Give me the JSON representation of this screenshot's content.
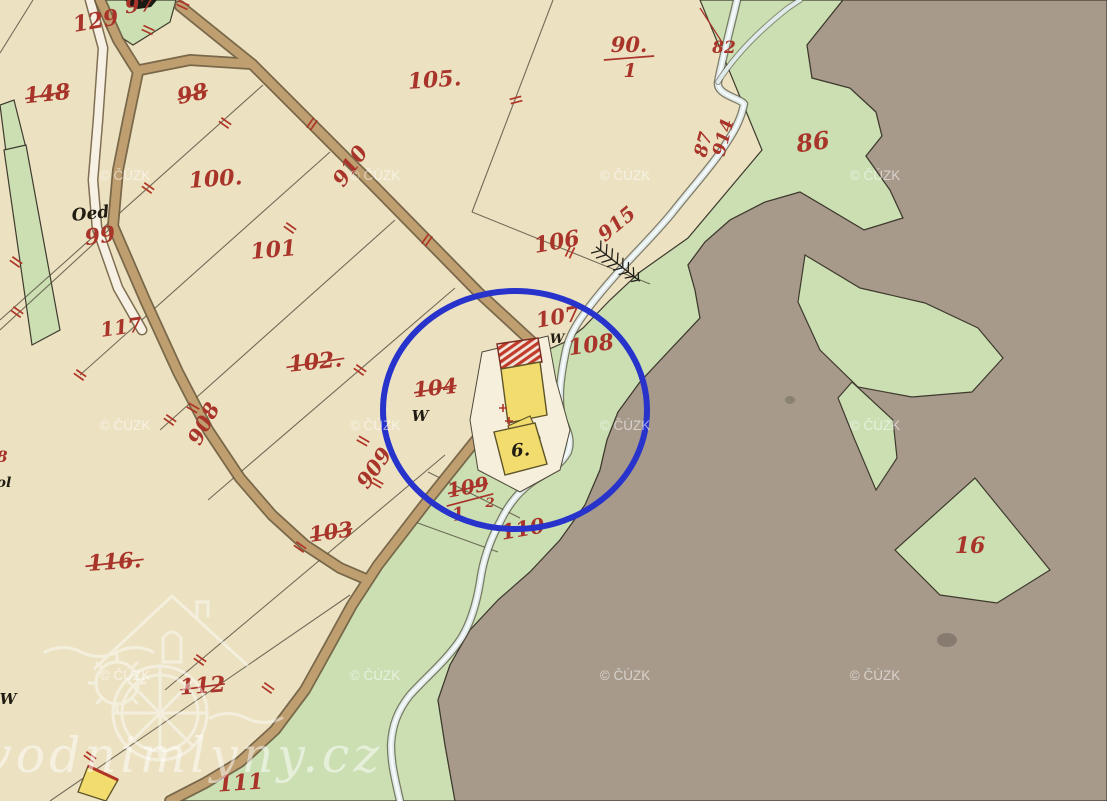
{
  "map": {
    "copyright_watermark": "© ČÚZK",
    "site_watermark": "vodnimlyny.cz",
    "colors": {
      "field_cream": "#ece2c2",
      "meadow_green": "#cbdfb3",
      "forest_gray": "#a79a8b",
      "road_brown": "#bf9f6f",
      "water_blue": "#dfeaea",
      "building_yellow": "#f1dc6d",
      "roof_red": "#c23b2a",
      "highlight_blue": "#2733cb",
      "label_red": "#a8342a"
    },
    "labels": [
      {
        "text": "129",
        "x": 97,
        "y": 28,
        "rot": -10,
        "size": 22,
        "cls": "red",
        "struck": false
      },
      {
        "text": "97",
        "x": 140,
        "y": 12,
        "rot": -5,
        "size": 21,
        "cls": "red",
        "struck": false
      },
      {
        "text": "148",
        "x": 48,
        "y": 101,
        "rot": -6,
        "size": 22,
        "cls": "red",
        "struck": true
      },
      {
        "text": "98",
        "x": 194,
        "y": 101,
        "rot": -12,
        "size": 22,
        "cls": "red",
        "struck": true
      },
      {
        "text": "100.",
        "x": 216,
        "y": 186,
        "rot": -4,
        "size": 22,
        "cls": "red",
        "struck": false
      },
      {
        "text": "101",
        "x": 274,
        "y": 257,
        "rot": -5,
        "size": 22,
        "cls": "red",
        "struck": false
      },
      {
        "text": "105.",
        "x": 435,
        "y": 87,
        "rot": -4,
        "size": 22,
        "cls": "red",
        "struck": false
      },
      {
        "text": "82",
        "x": 724,
        "y": 53,
        "rot": 0,
        "size": 17,
        "cls": "red",
        "struck": false
      },
      {
        "text": "86",
        "x": 814,
        "y": 150,
        "rot": -8,
        "size": 24,
        "cls": "red",
        "struck": false
      },
      {
        "text": "87",
        "x": 709,
        "y": 146,
        "rot": -75,
        "size": 18,
        "cls": "red",
        "struck": false
      },
      {
        "text": "914",
        "x": 729,
        "y": 139,
        "rot": -75,
        "size": 18,
        "cls": "red",
        "struck": false
      },
      {
        "text": "915",
        "x": 621,
        "y": 229,
        "rot": -40,
        "size": 20,
        "cls": "red",
        "struck": false
      },
      {
        "text": "106",
        "x": 558,
        "y": 249,
        "rot": -10,
        "size": 22,
        "cls": "red",
        "struck": false
      },
      {
        "text": "107",
        "x": 559,
        "y": 324,
        "rot": -10,
        "size": 21,
        "cls": "red",
        "struck": false
      },
      {
        "text": "108",
        "x": 592,
        "y": 352,
        "rot": -8,
        "size": 22,
        "cls": "red",
        "struck": false
      },
      {
        "text": "99",
        "x": 101,
        "y": 243,
        "rot": -8,
        "size": 22,
        "cls": "red",
        "struck": false
      },
      {
        "text": "117",
        "x": 122,
        "y": 334,
        "rot": -8,
        "size": 20,
        "cls": "red",
        "struck": false
      },
      {
        "text": "102.",
        "x": 316,
        "y": 369,
        "rot": -6,
        "size": 22,
        "cls": "red",
        "struck": true
      },
      {
        "text": "104",
        "x": 436,
        "y": 395,
        "rot": -6,
        "size": 21,
        "cls": "red",
        "struck": true
      },
      {
        "text": "910",
        "x": 356,
        "y": 170,
        "rot": -55,
        "size": 21,
        "cls": "red",
        "struck": false
      },
      {
        "text": "908",
        "x": 210,
        "y": 427,
        "rot": -62,
        "size": 21,
        "cls": "red",
        "struck": false
      },
      {
        "text": "909",
        "x": 380,
        "y": 472,
        "rot": -55,
        "size": 21,
        "cls": "red",
        "struck": false
      },
      {
        "text": "103",
        "x": 332,
        "y": 539,
        "rot": -8,
        "size": 21,
        "cls": "red",
        "struck": true
      },
      {
        "text": "116.",
        "x": 115,
        "y": 569,
        "rot": -4,
        "size": 22,
        "cls": "red",
        "struck": true
      },
      {
        "text": "110",
        "x": 524,
        "y": 536,
        "rot": -10,
        "size": 21,
        "cls": "red",
        "struck": false
      },
      {
        "text": "112",
        "x": 203,
        "y": 693,
        "rot": -4,
        "size": 22,
        "cls": "red",
        "struck": true
      },
      {
        "text": "111",
        "x": 241,
        "y": 790,
        "rot": -4,
        "size": 22,
        "cls": "red",
        "struck": false
      },
      {
        "text": "16",
        "x": 970,
        "y": 553,
        "rot": 0,
        "size": 22,
        "cls": "red",
        "struck": false
      },
      {
        "text": "2",
        "x": 490,
        "y": 507,
        "rot": 0,
        "size": 13,
        "cls": "red",
        "struck": false
      },
      {
        "text": "8",
        "x": 2,
        "y": 462,
        "rot": 0,
        "size": 16,
        "cls": "red",
        "struck": false
      },
      {
        "text": "W",
        "x": 420,
        "y": 421,
        "rot": 0,
        "size": 15,
        "cls": "black",
        "struck": false
      },
      {
        "text": "W",
        "x": 557,
        "y": 343,
        "rot": 0,
        "size": 13,
        "cls": "black",
        "struck": false
      },
      {
        "text": "W",
        "x": 8,
        "y": 704,
        "rot": 0,
        "size": 15,
        "cls": "black",
        "struck": false
      },
      {
        "text": "Oed",
        "x": 91,
        "y": 219,
        "rot": -6,
        "size": 17,
        "cls": "black",
        "struck": false
      },
      {
        "text": "ol",
        "x": 4,
        "y": 487,
        "rot": 0,
        "size": 14,
        "cls": "black",
        "struck": false
      },
      {
        "text": "6.",
        "x": 521,
        "y": 456,
        "rot": -5,
        "size": 18,
        "cls": "black",
        "struck": false
      }
    ],
    "fractions": [
      {
        "num": "90.",
        "den": "1",
        "x": 629,
        "y": 52,
        "rot": 0,
        "size": 21,
        "struck": false,
        "den_dx": 1
      },
      {
        "num": "109",
        "den": "1",
        "x": 469,
        "y": 494,
        "rot": -10,
        "size": 20,
        "struck": true,
        "den_dx": -14
      }
    ]
  }
}
